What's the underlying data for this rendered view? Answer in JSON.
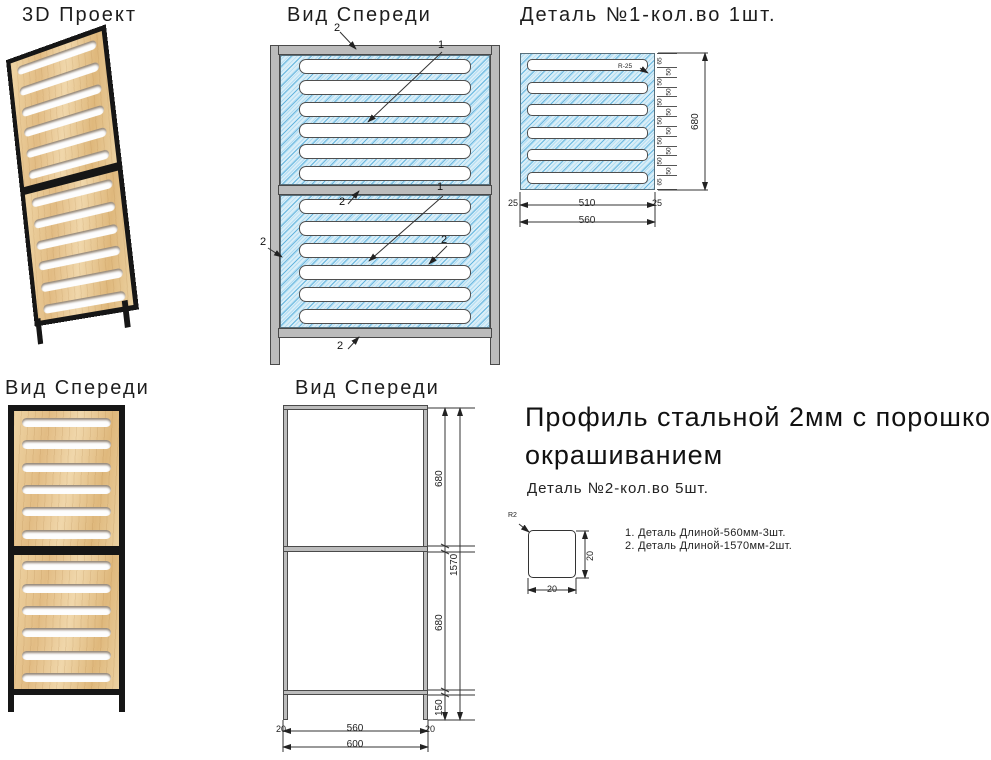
{
  "colors": {
    "background": "#ffffff",
    "hatch_fill": "#d9eef8",
    "hatch_line": "#3ca0d4",
    "frame_gray": "#bcbcbc",
    "frame_outline": "#4a4a4a",
    "wood": "#e7c491",
    "frame_black": "#161616",
    "ink": "#1d1d1d"
  },
  "view3d": {
    "title": "3D Проект"
  },
  "front_top": {
    "title": "Вид Спереди",
    "callouts": {
      "top_bar": "2",
      "upper_panel": "1",
      "mid_bar": "2",
      "left_bar": "2",
      "right_bar": "2",
      "lower_panel": "1",
      "bottom_bar": "2"
    }
  },
  "detail1": {
    "title": "Деталь №1-кол.во 1шт.",
    "radius_label": "R-25",
    "chain": [
      "65",
      "50",
      "50",
      "50",
      "50",
      "50",
      "50",
      "50",
      "50",
      "50",
      "50",
      "50",
      "65"
    ],
    "total_height": "680",
    "margin_left": "25",
    "slot_length": "510",
    "margin_right": "25",
    "total_width": "560"
  },
  "front_bottom": {
    "title": "Вид Спереди"
  },
  "frame_view": {
    "title": "Вид Спереди",
    "upper_section": "680",
    "lower_section": "680",
    "leg_height": "150",
    "total_height": "1570",
    "left_offset": "20",
    "inner_width": "560",
    "right_offset": "20",
    "total_width": "600"
  },
  "spec": {
    "headline_line1": "Профиль стальной 2мм с порошковым",
    "headline_line2": "окрашиванием",
    "subtitle": "Деталь №2-кол.во 5шт.",
    "profile": {
      "radius_label": "R2",
      "width": "20",
      "height": "20"
    },
    "notes": [
      "1. Деталь Длиной-560мм-3шт.",
      "2. Деталь Длиной-1570мм-2шт."
    ]
  }
}
